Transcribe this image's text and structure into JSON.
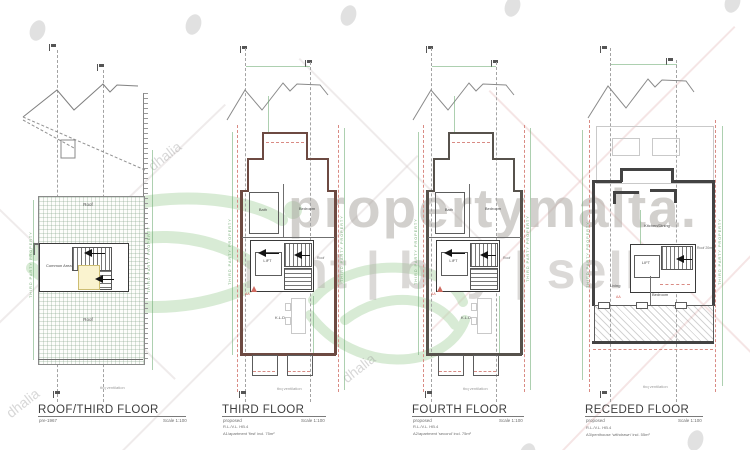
{
  "watermark": {
    "brand_line1": "propertymalta.",
    "brand_line2": "rent | buy | sell",
    "agency": "dhalia"
  },
  "colors": {
    "wall_red": "#6d4a42",
    "wall_dark": "#434343",
    "boundary_red": "#d98b84",
    "dimension_green": "#69a96f",
    "watermark_green": "#b2d8ac",
    "watermark_gray": "#b0aca8"
  },
  "plans": [
    {
      "title": "ROOF/THIRD FLOOR",
      "status": "pre-1967",
      "scale": "Scale  1:100",
      "labels": {
        "roof_upper": "Roof",
        "roof_lower": "Roof",
        "common_area": "Common Area",
        "vent": "tbq ventilation",
        "boundary_left": "THIRD PARTY PROPERTY",
        "boundary_right": "THIRD PARTY PROPERTY"
      }
    },
    {
      "title": "THIRD FLOOR",
      "status": "proposed",
      "scale": "Scale  1:100",
      "ref_line": "R.L./V.L.  HB.4",
      "apartment_line": "A1/apartment 'first' incl. 75m²",
      "labels": {
        "bath": "Bath",
        "bedroom": "Bedroom",
        "lift": "LIFT",
        "living": "K.L.D.",
        "shaft": "Roof",
        "section": "AA",
        "vent": "tbq ventilation",
        "boundary_left": "THIRD PARTY PROPERTY",
        "boundary_right": "THIRD PARTY PROPERTY"
      }
    },
    {
      "title": "FOURTH FLOOR",
      "status": "proposed",
      "scale": "Scale  1:100",
      "ref_line": "R.L./V.L.  HB.4",
      "apartment_line": "A2/apartment 'second' incl. 75m²",
      "labels": {
        "bath": "Bath",
        "bedroom": "Bedroom",
        "lift": "LIFT",
        "living": "K.L.D.",
        "shaft": "Roof",
        "section": "AA",
        "vent": "tbq ventilation",
        "boundary_left": "THIRD PARTY PROPERTY",
        "boundary_right": "THIRD PARTY PROPERTY"
      }
    },
    {
      "title": "RECEDED FLOOR",
      "status": "proposed",
      "scale": "Scale  1:100",
      "ref_line": "R.L./V.L.  HB.4",
      "apartment_line": "A3/penthouse 'withdrawn' incl. 55m²",
      "labels": {
        "kitchen": "Kitchen/Dining",
        "living": "Living",
        "bedroom": "Bedroom",
        "lift": "LIFT",
        "roof_side": "Roof 20m",
        "section": "AA",
        "vent": "tbq ventilation",
        "boundary_left": "THIRD PARTY PROPERTY",
        "boundary_right": "THIRD PARTY PROPERTY"
      }
    }
  ]
}
